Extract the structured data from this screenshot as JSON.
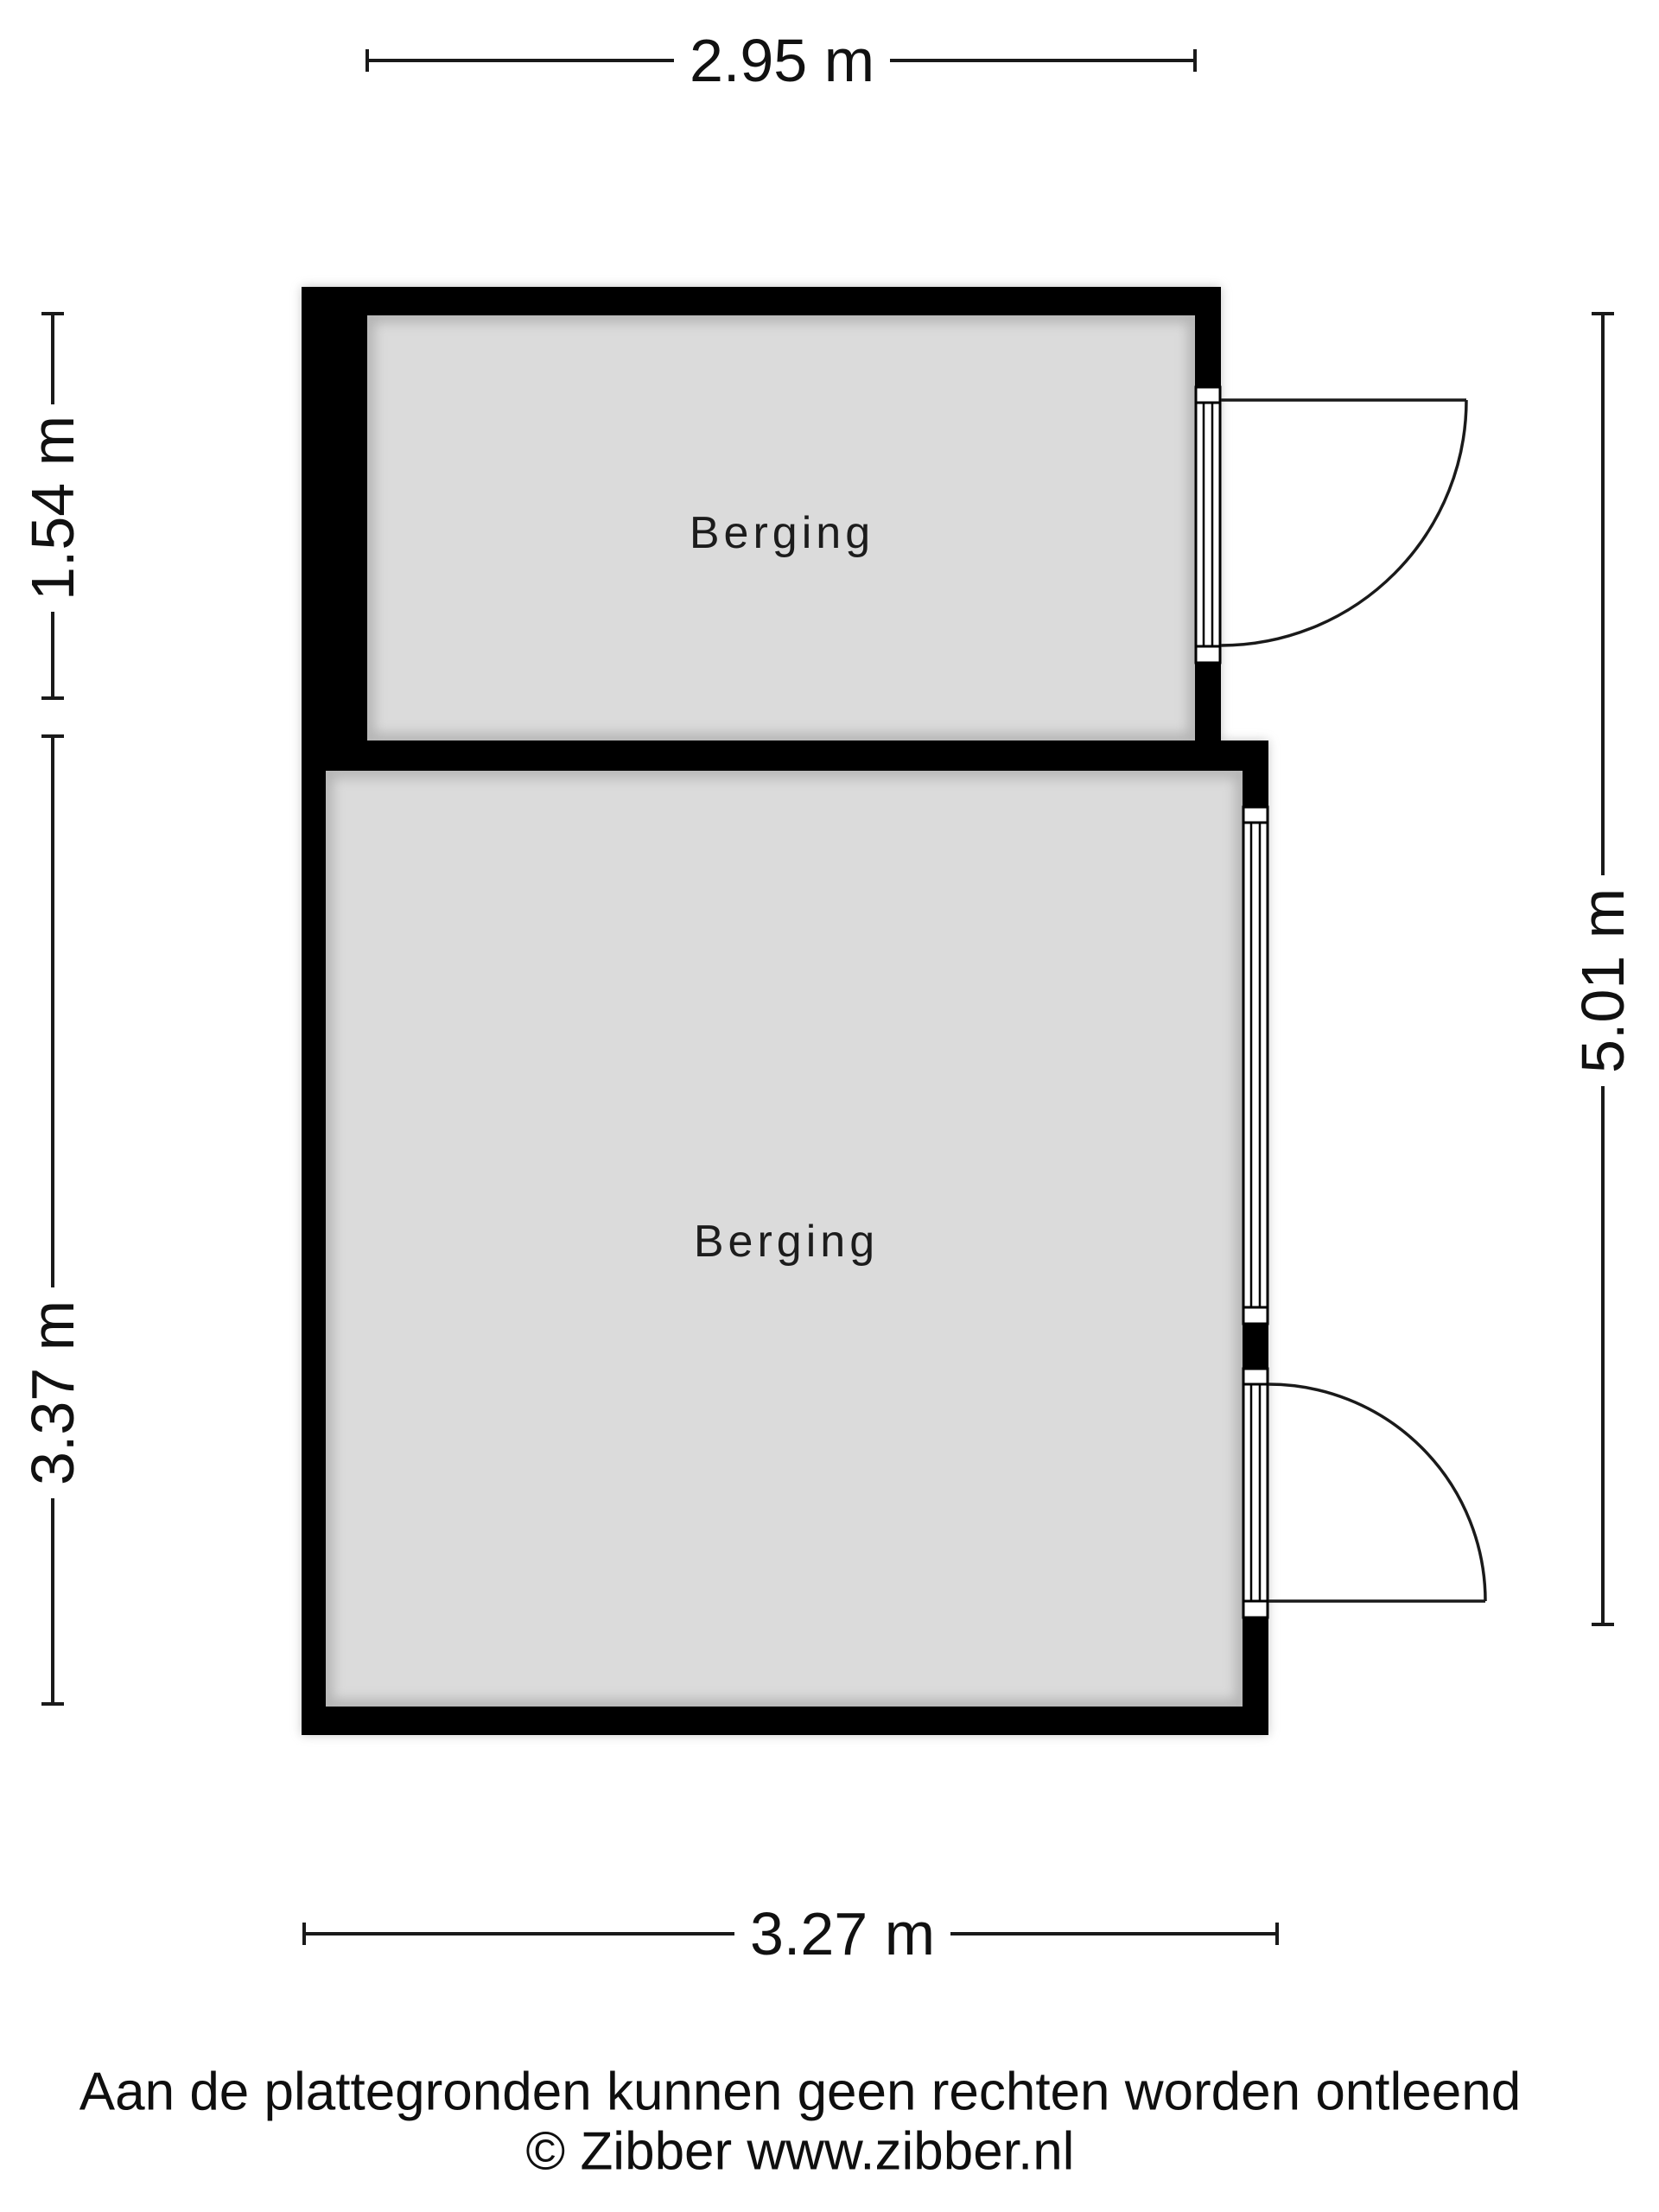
{
  "floorplan": {
    "rooms": [
      {
        "label": "Berging"
      },
      {
        "label": "Berging"
      }
    ],
    "dimensions": {
      "top": "2.95 m",
      "left_upper": "1.54 m",
      "left_lower": "3.37 m",
      "right": "5.01 m",
      "bottom": "3.27 m"
    },
    "colors": {
      "wall": "#000000",
      "floor": "#dbdbdb",
      "background": "#ffffff"
    }
  },
  "footer": {
    "disclaimer": "Aan de plattegronden kunnen geen rechten worden ontleend",
    "copyright": "© Zibber www.zibber.nl"
  }
}
